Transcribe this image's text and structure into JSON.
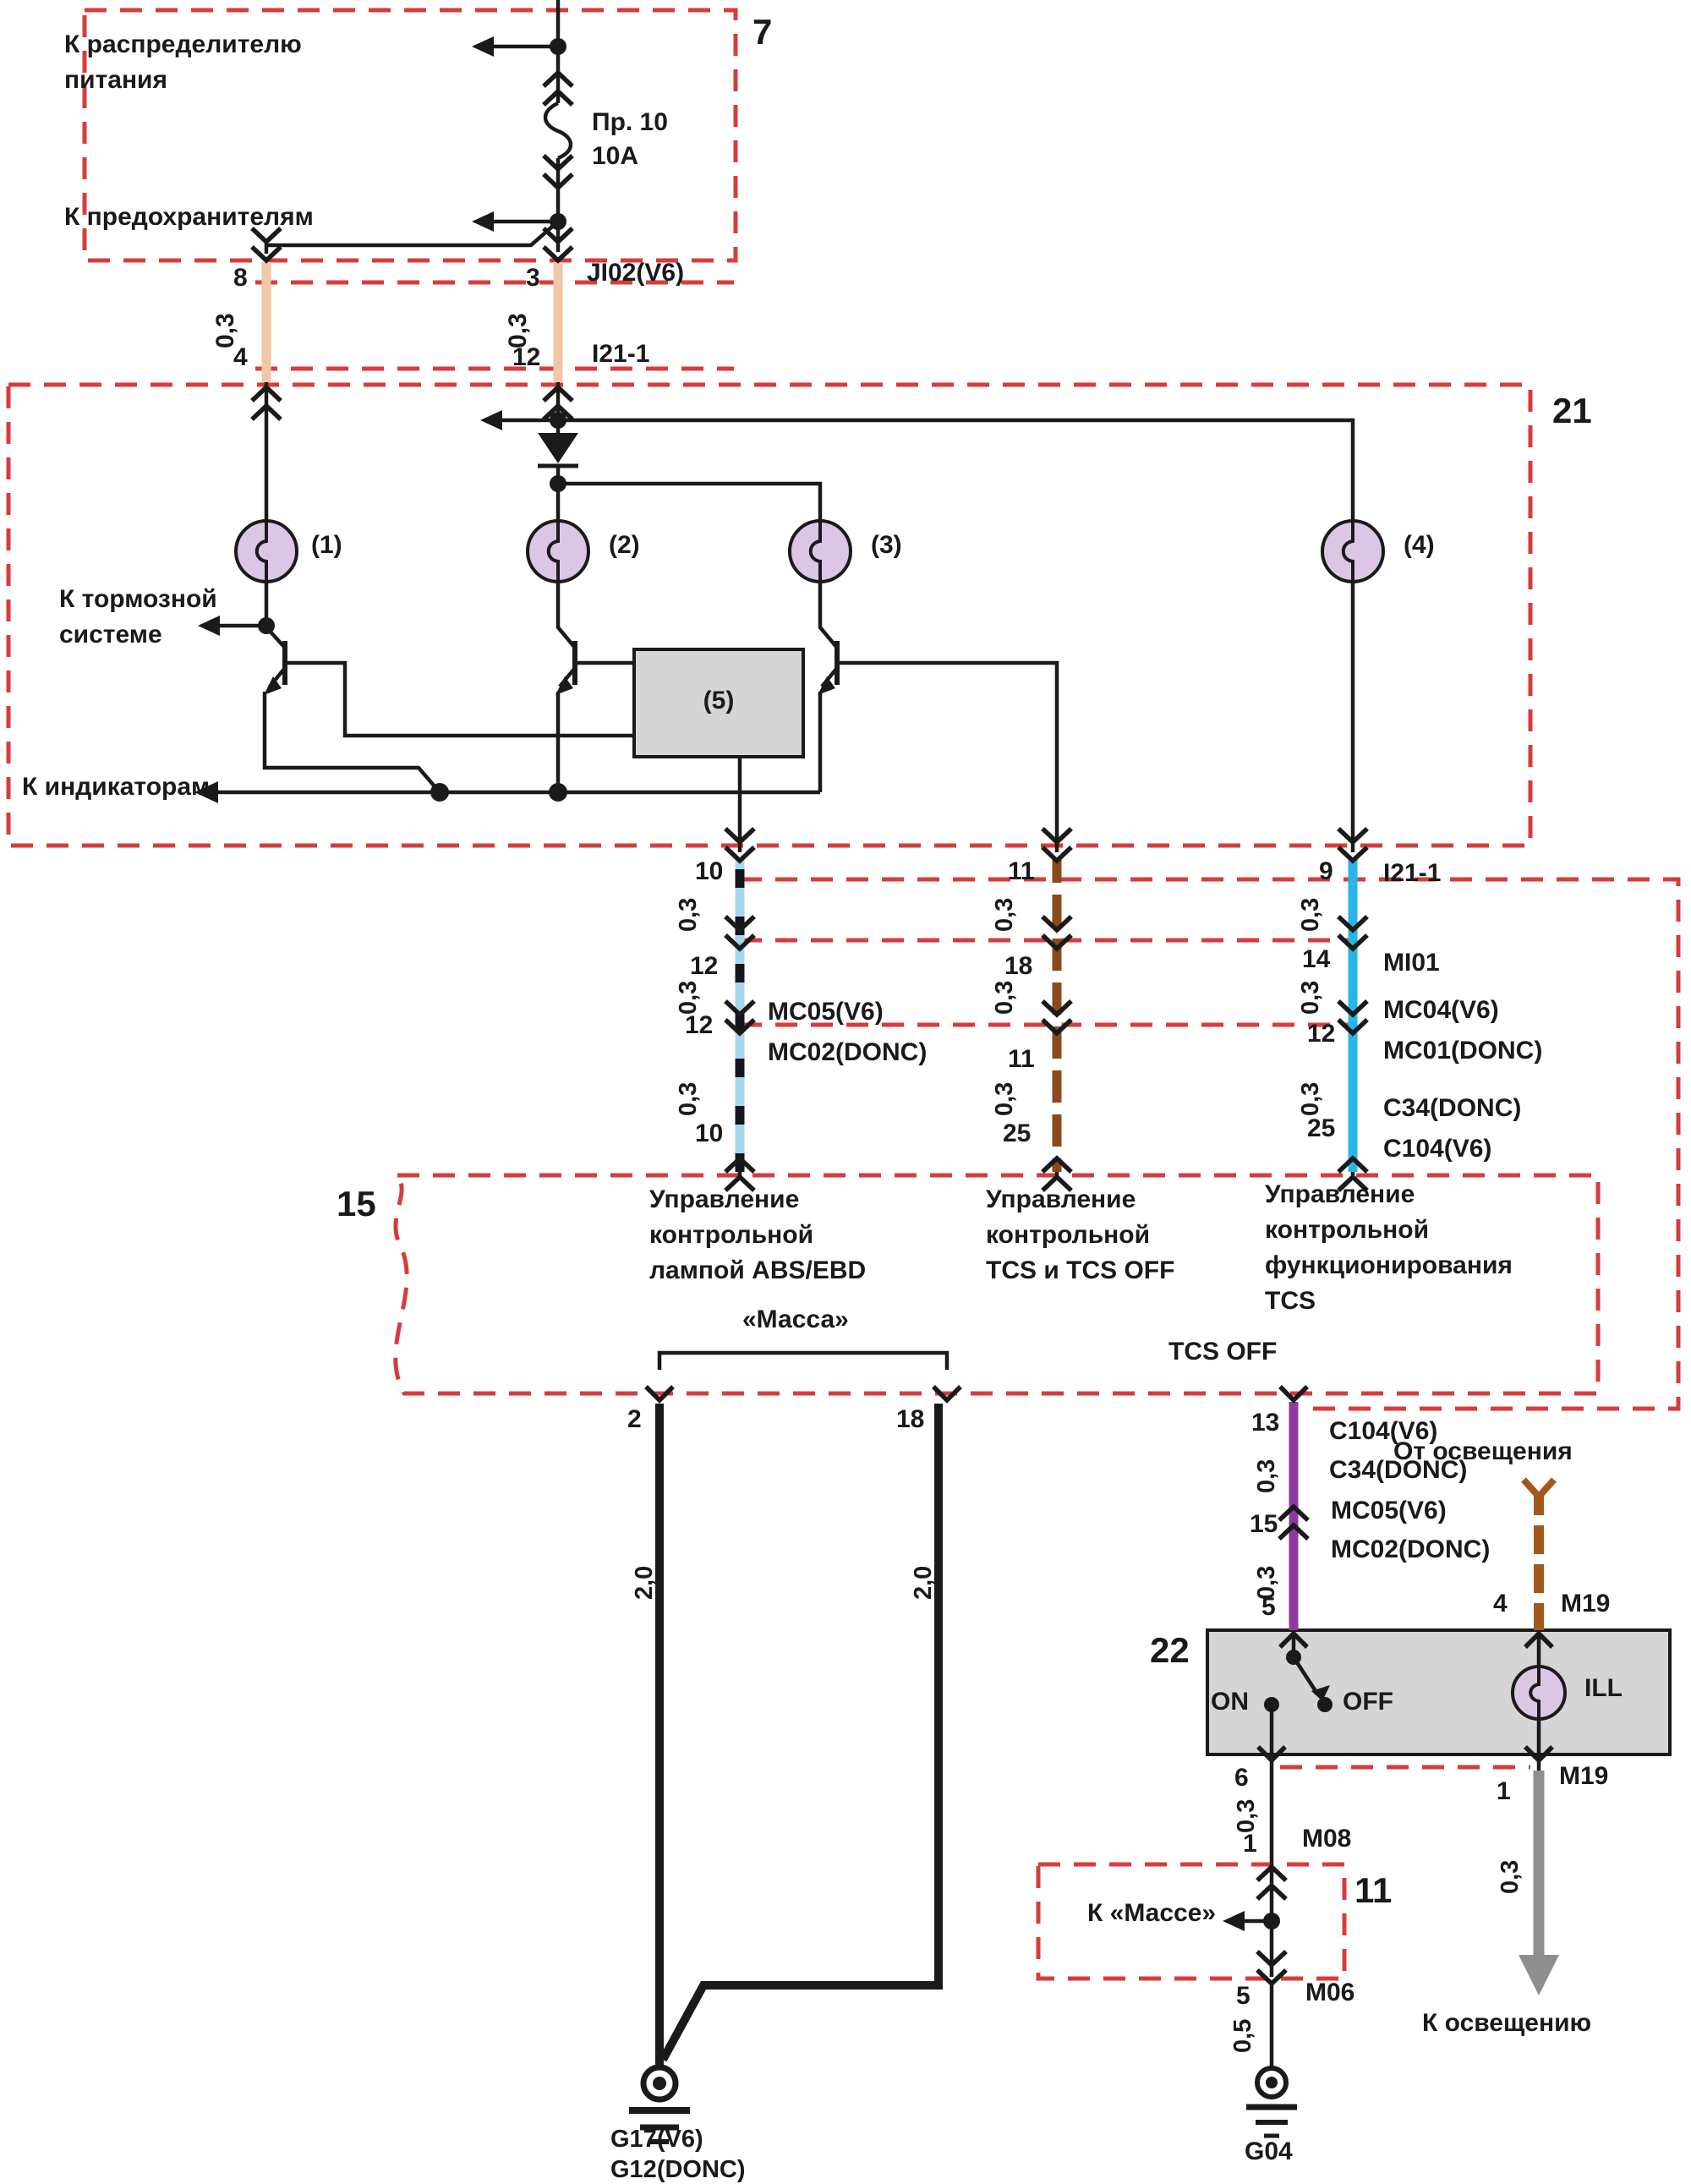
{
  "power_block": {
    "num": "7",
    "line1": "К распределителю",
    "line2": "питания",
    "fuse_name": "Пр. 10",
    "fuse_rating": "10А",
    "to_fuses": "К предохранителям"
  },
  "top_conn": {
    "jt": "JI02(V6)",
    "jb": "I21-1",
    "lp1": "8",
    "lg": "0,3",
    "lp2": "4",
    "rp1": "3",
    "rg": "0,3",
    "rp2": "12"
  },
  "abs_unit": {
    "num": "21",
    "l1": "(1)",
    "l2": "(2)",
    "l3": "(3)",
    "l4": "(4)",
    "mod": "(5)",
    "brake1": "К тормозной",
    "brake2": "системе",
    "ind": "К индикаторам"
  },
  "h1": {
    "p1": "10",
    "g1": "0,3",
    "p2": "12",
    "g2": "0,3",
    "p3": "12",
    "c1": "MC05(V6)",
    "c2": "MC02(DONC)",
    "g3": "0,3",
    "p4": "10"
  },
  "h2": {
    "p1": "11",
    "g1": "0,3",
    "p2": "18",
    "g2": "0,3",
    "p3": "11",
    "g3": "0,3",
    "p4": "25"
  },
  "h3": {
    "p1": "9",
    "c0": "I21-1",
    "g1": "0,3",
    "p2": "14",
    "cb": "MI01",
    "g2": "0,3",
    "p3": "12",
    "c1": "MC04(V6)",
    "c2": "MC01(DONC)",
    "g3": "0,3",
    "p4": "25",
    "d1": "C34(DONC)",
    "d2": "C104(V6)"
  },
  "ecu": {
    "num": "15",
    "s1a": "Управление",
    "s1b": "контрольной",
    "s1c": "лампой ABS/EBD",
    "s2a": "Управление",
    "s2b": "контрольной",
    "s2c": "TCS и TCS OFF",
    "s3a": "Управление",
    "s3b": "контрольной",
    "s3c": "функционирования",
    "s3d": "TCS",
    "massa": "«Масса»",
    "tcsoff": "TCS OFF"
  },
  "gnd": {
    "p2": "2",
    "p18": "18",
    "gL": "2,0",
    "gR": "2,0",
    "g17": "G17(V6)",
    "g12": "G12(DONC)"
  },
  "tcs": {
    "p13": "13",
    "c104": "C104(V6)",
    "c34": "C34(DONC)",
    "g1": "0,3",
    "p15": "15",
    "mc05": "MC05(V6)",
    "mc02": "MC02(DONC)",
    "g2": "0,3",
    "p5": "5"
  },
  "illum": {
    "from": "От освещения",
    "p4": "4",
    "m19": "M19"
  },
  "sw": {
    "num": "22",
    "on": "ON",
    "off": "OFF",
    "ill": "ILL",
    "p6": "6",
    "p1": "1",
    "m19": "M19"
  },
  "m08path": {
    "g": "0,3",
    "p1": "1",
    "m08": "M08"
  },
  "gnd11": {
    "num": "11",
    "label": "К «Массе»",
    "p5": "5",
    "m06": "M06",
    "g": "0,5",
    "g04": "G04"
  },
  "illout": {
    "g": "0,3",
    "to": "К освещению"
  }
}
